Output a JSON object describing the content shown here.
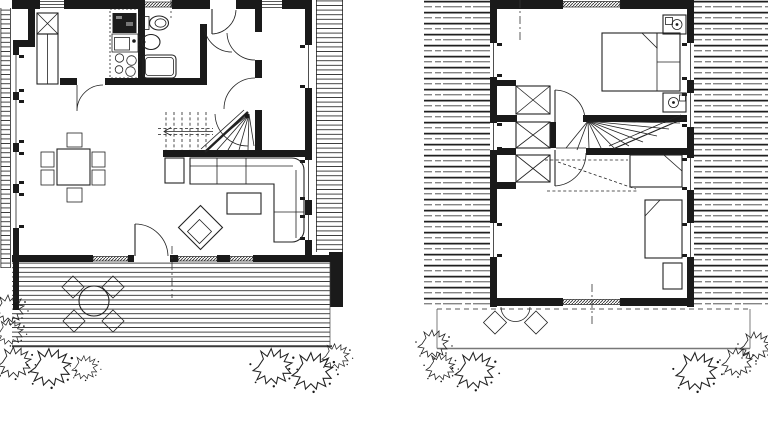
{
  "canvas": {
    "width": 768,
    "height": 422,
    "background": "#ffffff",
    "ink": "#1a1a1a",
    "hatch_gray": "#3c3c3c"
  },
  "drawing": {
    "kind": "architectural floor plan drawing, two levels side by side, black ink on white",
    "plans": [
      {
        "id": "ground-floor-plan",
        "side": "left",
        "features": [
          "entry-wardrobe-x",
          "tall-cupboard",
          "kitchen-counter",
          "kitchen-sink",
          "cooktop-4-burners",
          "toilet-wc",
          "washbasin",
          "shower-tray",
          "hallway-door-arcs",
          "winder-staircase",
          "dining-table-6-chairs",
          "corner-sofa",
          "side-table",
          "coffee-table",
          "lounge-chair-rotated",
          "terrace-deck-planks",
          "round-patio-table-4-chairs",
          "shrubs"
        ]
      },
      {
        "id": "upper-floor-plan",
        "side": "right",
        "features": [
          "double-bed-2-pillows",
          "nightstand-with-lamp-top",
          "nightstand-with-lamp-bottom",
          "built-in-closets-x",
          "winder-staircase",
          "single-bed-horizontal",
          "single-bed-vertical",
          "small-cabinet",
          "side-roof-decks",
          "balcony-2-chairs-round-table",
          "shrubs"
        ]
      }
    ]
  }
}
